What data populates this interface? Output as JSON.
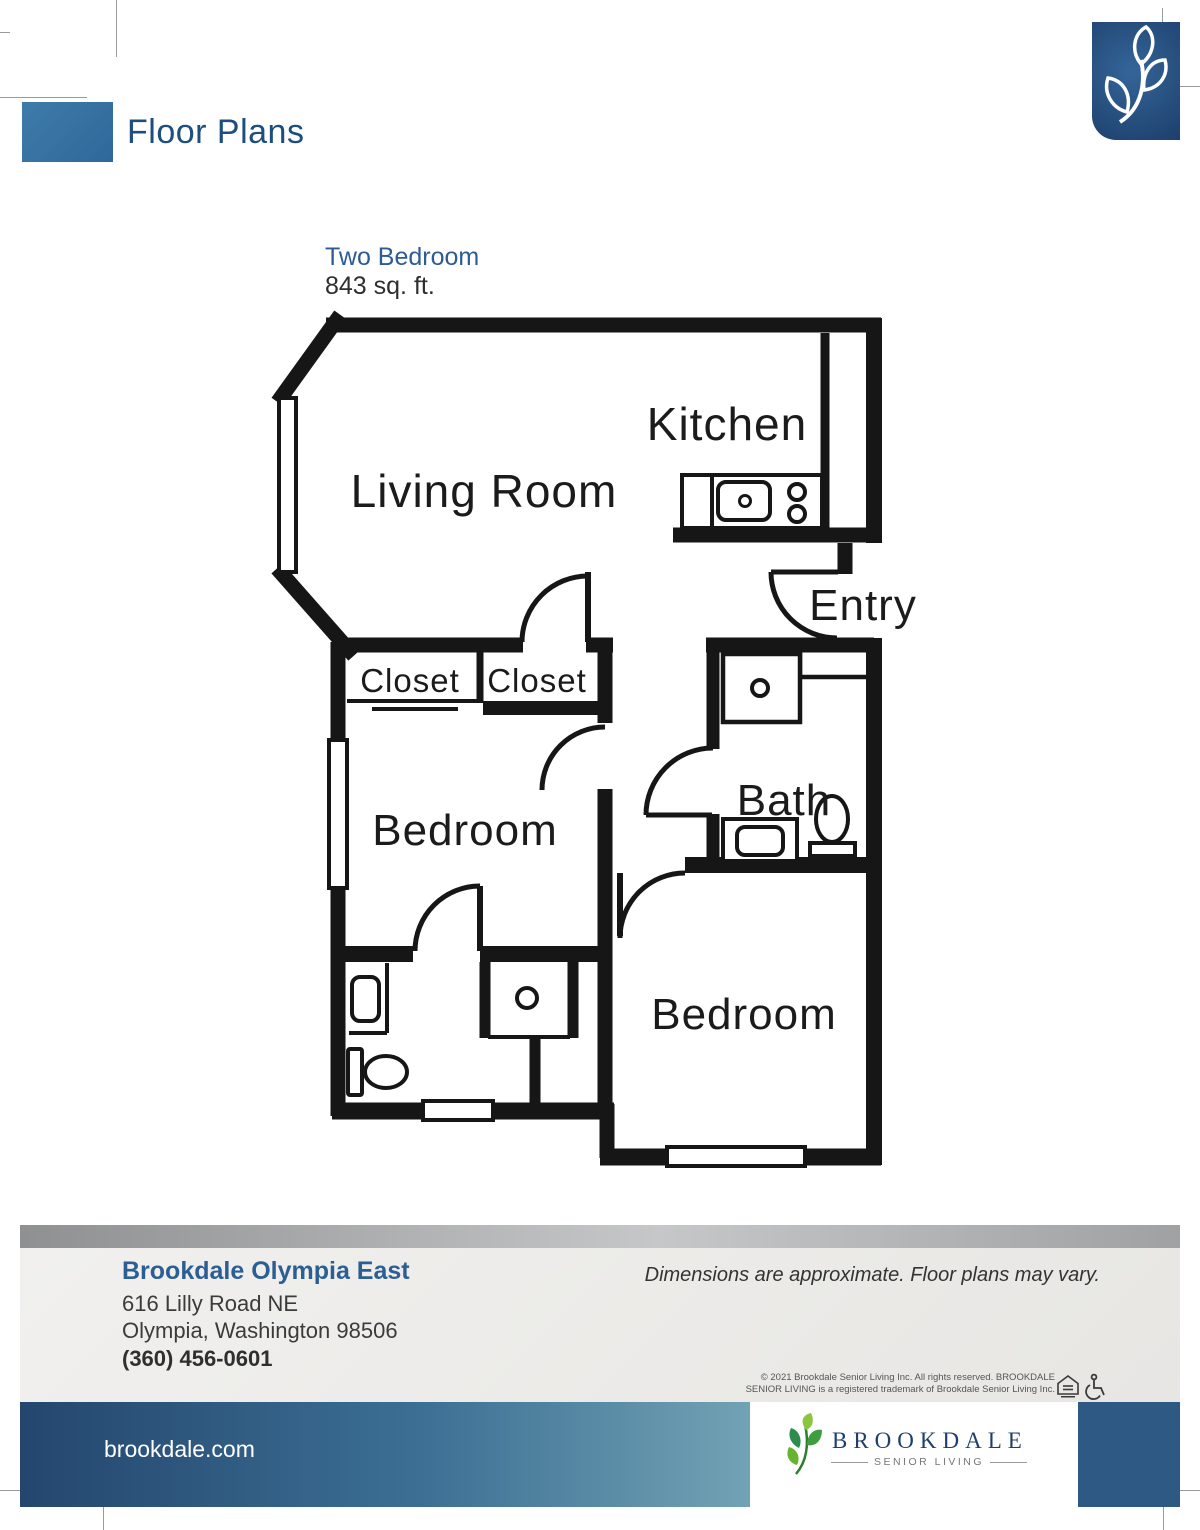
{
  "page": {
    "title": "Floor Plans"
  },
  "plan": {
    "name": "Two Bedroom",
    "area": "843 sq. ft.",
    "rooms": {
      "living_room": "Living Room",
      "kitchen": "Kitchen",
      "entry": "Entry",
      "closet_left": "Closet",
      "closet_right": "Closet",
      "bath": "Bath",
      "bedroom_1": "Bedroom",
      "bedroom_2": "Bedroom"
    }
  },
  "footer": {
    "community": "Brookdale Olympia East",
    "address_line1": "616 Lilly Road NE",
    "address_line2": "Olympia, Washington 98506",
    "phone": "(360) 456-0601",
    "disclaimer": "Dimensions are approximate. Floor plans may vary.",
    "copyright_line1": "© 2021 Brookdale Senior Living Inc. All rights reserved. BROOKDALE",
    "copyright_line2": "SENIOR LIVING is a registered trademark of Brookdale Senior Living Inc.",
    "website": "brookdale.com",
    "brand": "BROOKDALE",
    "brand_sub": "SENIOR LIVING"
  },
  "icons": {
    "corner_leaf": "brookdale-leaf-icon",
    "footer_leaf": "brookdale-leaf-icon",
    "equal_housing": "equal-housing-icon",
    "wheelchair": "wheelchair-accessible-icon"
  },
  "colors": {
    "accent_blue": "#2e689a",
    "title_blue": "#1e4e7e",
    "navy": "#1d3f6d",
    "heading_blue": "#2d5b96",
    "community_blue": "#2b5f94",
    "bar_square_blue": "#2e5984",
    "leaf_green": "#3e9d3e",
    "wall_black": "#161616",
    "text_dark": "#2f2f2f"
  }
}
